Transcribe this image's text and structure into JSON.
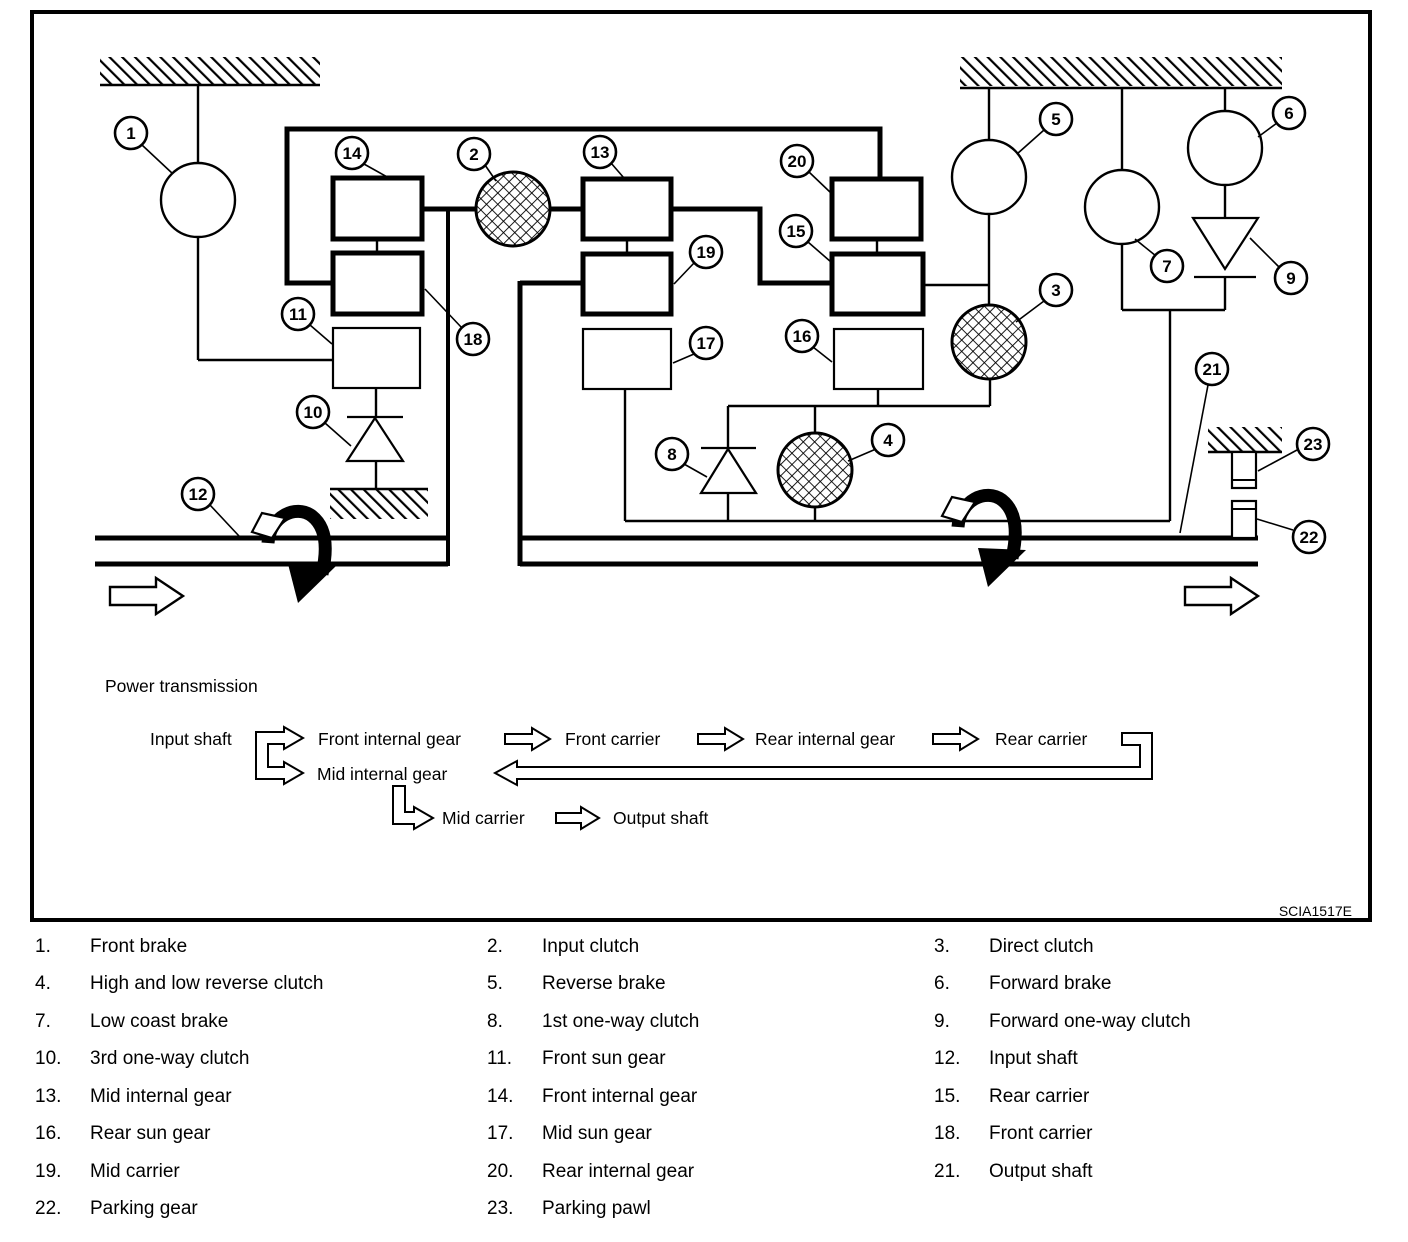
{
  "diagram": {
    "code": "SCIA1517E",
    "flow": {
      "title": "Power transmission",
      "input_shaft": "Input shaft",
      "front_internal_gear": "Front internal gear",
      "front_carrier": "Front carrier",
      "rear_internal_gear": "Rear internal gear",
      "rear_carrier": "Rear carrier",
      "mid_internal_gear": "Mid internal gear",
      "mid_carrier": "Mid carrier",
      "output_shaft": "Output shaft"
    },
    "callouts": [
      "1",
      "2",
      "3",
      "4",
      "5",
      "6",
      "7",
      "8",
      "9",
      "10",
      "11",
      "12",
      "13",
      "14",
      "15",
      "16",
      "17",
      "18",
      "19",
      "20",
      "21",
      "22",
      "23"
    ]
  },
  "legend": {
    "items": [
      {
        "num": "1.",
        "label": "Front brake"
      },
      {
        "num": "2.",
        "label": "Input clutch"
      },
      {
        "num": "3.",
        "label": "Direct clutch"
      },
      {
        "num": "4.",
        "label": "High and low reverse clutch"
      },
      {
        "num": "5.",
        "label": "Reverse brake"
      },
      {
        "num": "6.",
        "label": "Forward brake"
      },
      {
        "num": "7.",
        "label": "Low coast brake"
      },
      {
        "num": "8.",
        "label": "1st one-way clutch"
      },
      {
        "num": "9.",
        "label": "Forward one-way clutch"
      },
      {
        "num": "10.",
        "label": "3rd one-way clutch"
      },
      {
        "num": "11.",
        "label": "Front sun gear"
      },
      {
        "num": "12.",
        "label": "Input shaft"
      },
      {
        "num": "13.",
        "label": "Mid internal gear"
      },
      {
        "num": "14.",
        "label": "Front internal gear"
      },
      {
        "num": "15.",
        "label": "Rear carrier"
      },
      {
        "num": "16.",
        "label": "Rear sun gear"
      },
      {
        "num": "17.",
        "label": "Mid sun gear"
      },
      {
        "num": "18.",
        "label": "Front carrier"
      },
      {
        "num": "19.",
        "label": "Mid carrier"
      },
      {
        "num": "20.",
        "label": "Rear internal gear"
      },
      {
        "num": "21.",
        "label": "Output shaft"
      },
      {
        "num": "22.",
        "label": "Parking gear"
      },
      {
        "num": "23.",
        "label": "Parking pawl"
      }
    ]
  },
  "colors": {
    "ink": "#000000",
    "paper": "#ffffff"
  }
}
